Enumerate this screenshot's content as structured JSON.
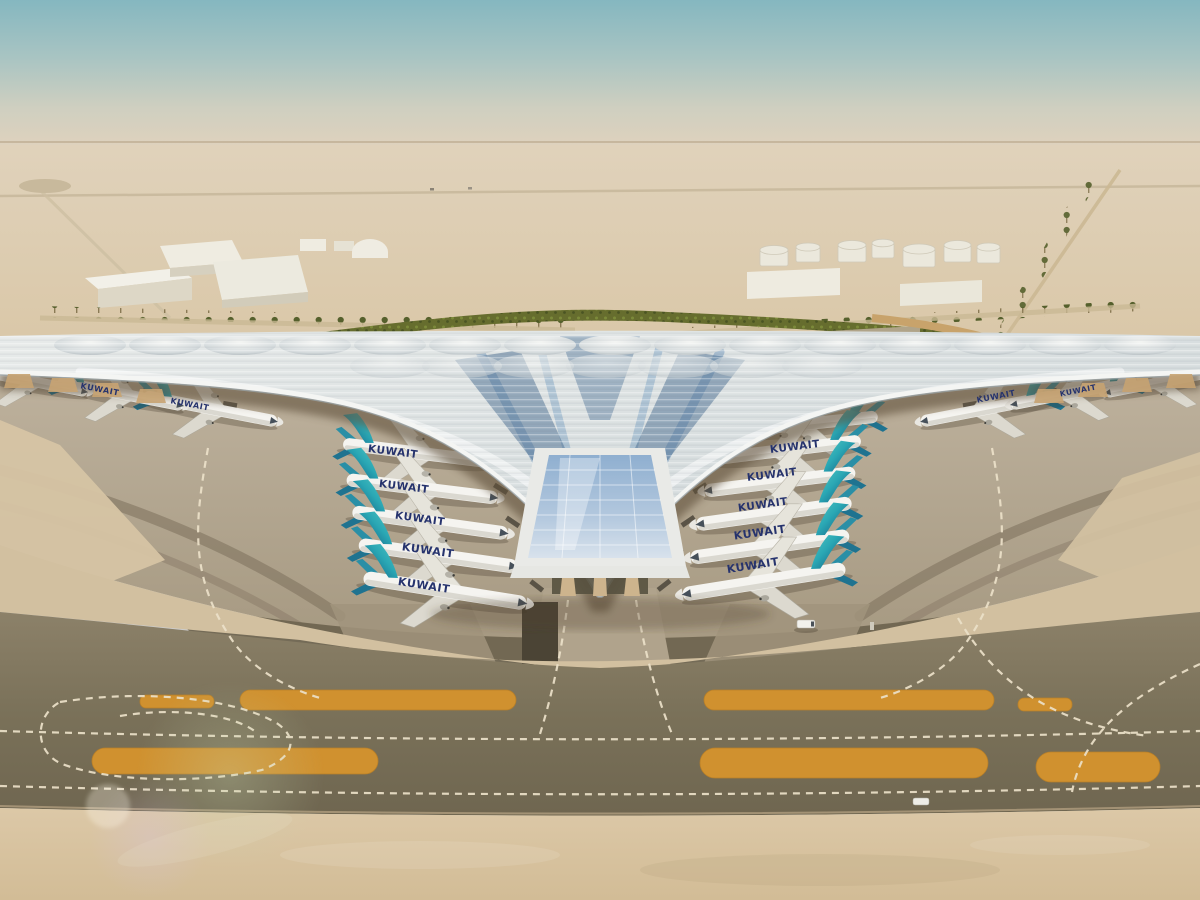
{
  "scene": {
    "airline_title": "KUWAIT"
  },
  "aircraft": {
    "title": "KUWAIT",
    "title_color": "#26336d",
    "tail_color_base": "#0f5078",
    "tail_color_tip": "#55c8c4",
    "visible_count": 17
  },
  "palette": {
    "sky_top": "#85b7c0",
    "sky_haze": "#e0d2bd",
    "desert_sand": "#dcc9a9",
    "apron_concrete": "#ada188",
    "taxiway_asphalt": "#7e755f",
    "gravel_strip": "#d0912f",
    "taxi_marking": "#ece1c9",
    "roof_silver": "#dfe3e3",
    "roof_glass_blue": "#8fb0d0",
    "landscape_green": "#666d2e",
    "soffit_tan": "#c7a372"
  }
}
